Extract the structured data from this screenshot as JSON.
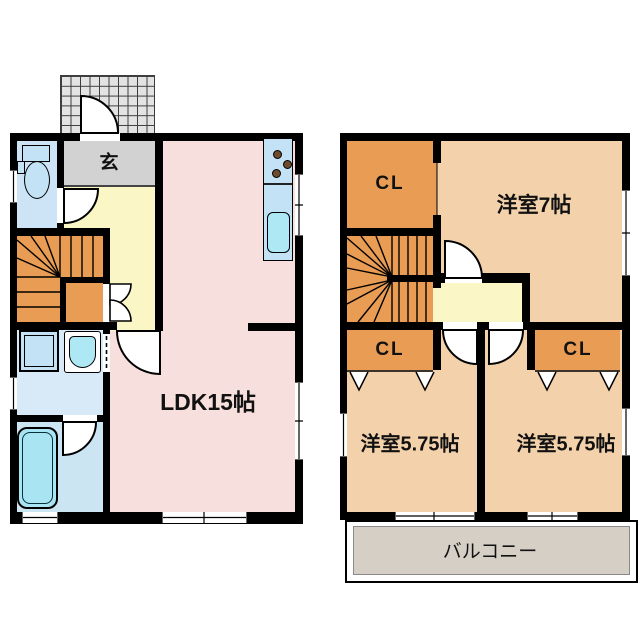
{
  "plan_title": "2-story house floor plan",
  "floor1": {
    "genkan_label": "玄",
    "ldk_label": "LDK15帖"
  },
  "floor2": {
    "closet_top_label": "CL",
    "main_room_label": "洋室7帖",
    "closet_left_label": "CL",
    "closet_right_label": "CL",
    "room_left_label": "洋室5.75帖",
    "room_right_label": "洋室5.75帖",
    "balcony_label": "バルコニー"
  },
  "colors": {
    "wall": "#000000",
    "ldk": "#F6DFDC",
    "hall": "#FBF6C6",
    "genkan": "#D2D2D2",
    "stairs": "#E99C53",
    "closet": "#E99C53",
    "room2f": "#F3D2AB",
    "balcony": "#D6CFC6",
    "toilet_room": "#CDE4F6",
    "washroom": "#D8EAF8",
    "bathroom": "#CCE5F2",
    "fixture_blue": "#C3E2F5",
    "tub": "#A9E4F3",
    "sink": "#ADE8F4",
    "tile": "#E3E3E3"
  }
}
